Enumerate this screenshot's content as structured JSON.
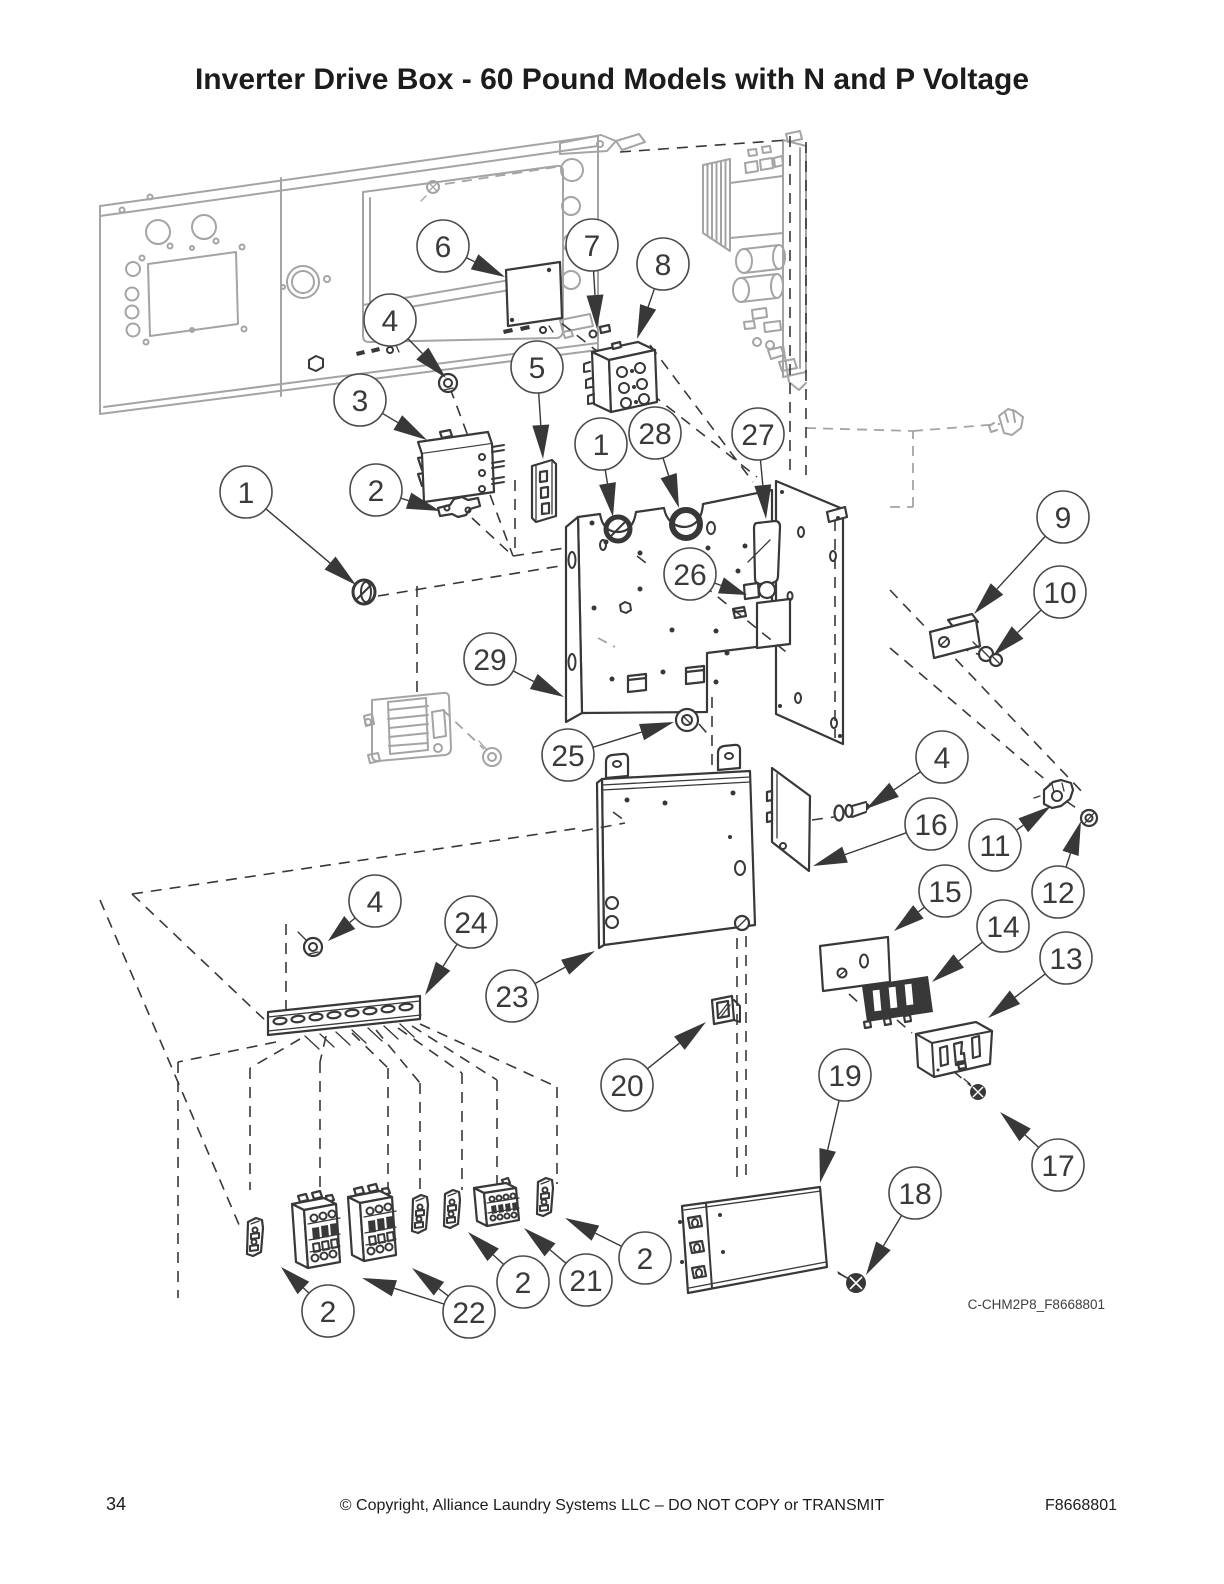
{
  "page": {
    "title": "Inverter Drive Box - 60 Pound Models with N and P Voltage",
    "figure_code": "C-CHM2P8_F8668801",
    "footer": {
      "page_number": "34",
      "copyright": "© Copyright, Alliance Laundry Systems LLC – DO NOT COPY or TRANSMIT",
      "document_number": "F8668801"
    }
  },
  "colors": {
    "ink": "#383838",
    "muted": "#a4a4a4",
    "paper": "#ffffff"
  },
  "callouts": [
    {
      "label": "6",
      "cx": 443,
      "cy": 246,
      "tx": 505,
      "ty": 277
    },
    {
      "label": "7",
      "cx": 592,
      "cy": 245,
      "tx": 597,
      "ty": 329
    },
    {
      "label": "8",
      "cx": 663,
      "cy": 264,
      "tx": 637,
      "ty": 339
    },
    {
      "label": "4",
      "cx": 390,
      "cy": 320,
      "tx": 446,
      "ty": 378
    },
    {
      "label": "5",
      "cx": 537,
      "cy": 367,
      "tx": 543,
      "ty": 459
    },
    {
      "label": "3",
      "cx": 360,
      "cy": 400,
      "tx": 427,
      "ty": 440
    },
    {
      "label": "1",
      "cx": 601,
      "cy": 444,
      "tx": 613,
      "ty": 517
    },
    {
      "label": "28",
      "cx": 655,
      "cy": 433,
      "tx": 679,
      "ty": 508
    },
    {
      "label": "27",
      "cx": 758,
      "cy": 434,
      "tx": 766,
      "ty": 519
    },
    {
      "label": "1",
      "cx": 246,
      "cy": 492,
      "tx": 356,
      "ty": 585
    },
    {
      "label": "2",
      "cx": 376,
      "cy": 490,
      "tx": 440,
      "ty": 511
    },
    {
      "label": "9",
      "cx": 1063,
      "cy": 517,
      "tx": 974,
      "ty": 614
    },
    {
      "label": "10",
      "cx": 1060,
      "cy": 592,
      "tx": 993,
      "ty": 656
    },
    {
      "label": "26",
      "cx": 690,
      "cy": 574,
      "tx": 747,
      "ty": 595
    },
    {
      "label": "29",
      "cx": 490,
      "cy": 659,
      "tx": 564,
      "ty": 697
    },
    {
      "label": "25",
      "cx": 568,
      "cy": 755,
      "tx": 674,
      "ty": 722
    },
    {
      "label": "4",
      "cx": 942,
      "cy": 757,
      "tx": 866,
      "ty": 809
    },
    {
      "label": "16",
      "cx": 931,
      "cy": 824,
      "tx": 813,
      "ty": 866
    },
    {
      "label": "11",
      "cx": 995,
      "cy": 845,
      "tx": 1051,
      "ty": 806
    },
    {
      "label": "12",
      "cx": 1058,
      "cy": 892,
      "tx": 1081,
      "ty": 821
    },
    {
      "label": "15",
      "cx": 945,
      "cy": 891,
      "tx": 894,
      "ty": 931
    },
    {
      "label": "14",
      "cx": 1003,
      "cy": 926,
      "tx": 932,
      "ty": 982
    },
    {
      "label": "13",
      "cx": 1066,
      "cy": 958,
      "tx": 988,
      "ty": 1018
    },
    {
      "label": "4",
      "cx": 375,
      "cy": 901,
      "tx": 328,
      "ty": 941
    },
    {
      "label": "24",
      "cx": 471,
      "cy": 922,
      "tx": 425,
      "ty": 995
    },
    {
      "label": "23",
      "cx": 512,
      "cy": 996,
      "tx": 595,
      "ty": 951
    },
    {
      "label": "20",
      "cx": 627,
      "cy": 1085,
      "tx": 706,
      "ty": 1022
    },
    {
      "label": "19",
      "cx": 845,
      "cy": 1075,
      "tx": 820,
      "ty": 1183
    },
    {
      "label": "2",
      "cx": 645,
      "cy": 1258,
      "tx": 565,
      "ty": 1218
    },
    {
      "label": "21",
      "cx": 586,
      "cy": 1280,
      "tx": 524,
      "ty": 1228
    },
    {
      "label": "2",
      "cx": 523,
      "cy": 1282,
      "tx": 468,
      "ty": 1232
    },
    {
      "label": "22",
      "cx": 469,
      "cy": 1312,
      "tx": 362,
      "ty": 1278,
      "tx2": 412,
      "ty2": 1268
    },
    {
      "label": "2",
      "cx": 328,
      "cy": 1311,
      "tx": 281,
      "ty": 1267
    },
    {
      "label": "18",
      "cx": 915,
      "cy": 1193,
      "tx": 866,
      "ty": 1275
    },
    {
      "label": "17",
      "cx": 1058,
      "cy": 1165,
      "tx": 1000,
      "ty": 1112
    }
  ]
}
